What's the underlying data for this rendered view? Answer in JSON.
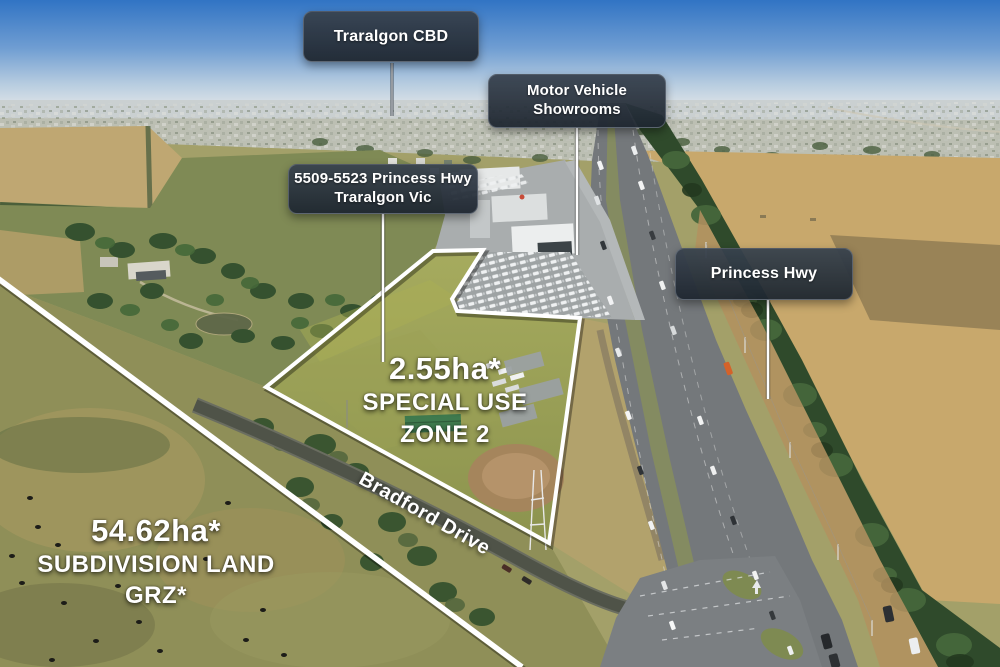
{
  "callouts": {
    "traralgon_cbd": {
      "label": "Traralgon CBD"
    },
    "motor_vehicle_showrooms": {
      "line1": "Motor Vehicle",
      "line2": "Showrooms"
    },
    "property_address": {
      "line1": "5509-5523 Princess Hwy",
      "line2": "Traralgon Vic"
    },
    "princess_hwy": {
      "label": "Princess Hwy"
    }
  },
  "overlays": {
    "parcel": {
      "area": "2.55ha*",
      "zone_line1": "SPECIAL USE",
      "zone_line2": "ZONE 2"
    },
    "subdivision": {
      "area": "54.62ha*",
      "type_line": "SUBDIVISION LAND",
      "zone_line": "GRZ*"
    },
    "road_label": "Bradford Drive"
  },
  "colors": {
    "callout_background": "#242e39",
    "callout_text": "#ffffff",
    "boundary_line": "#ffffff",
    "overlay_text": "#ffffff",
    "sky_top": "#3174c4",
    "parcel_grass": "#99a055",
    "paddock_tan": "#c8a86c",
    "highway_asphalt": "#74787b",
    "tree_dark": "#2f4a2b"
  }
}
